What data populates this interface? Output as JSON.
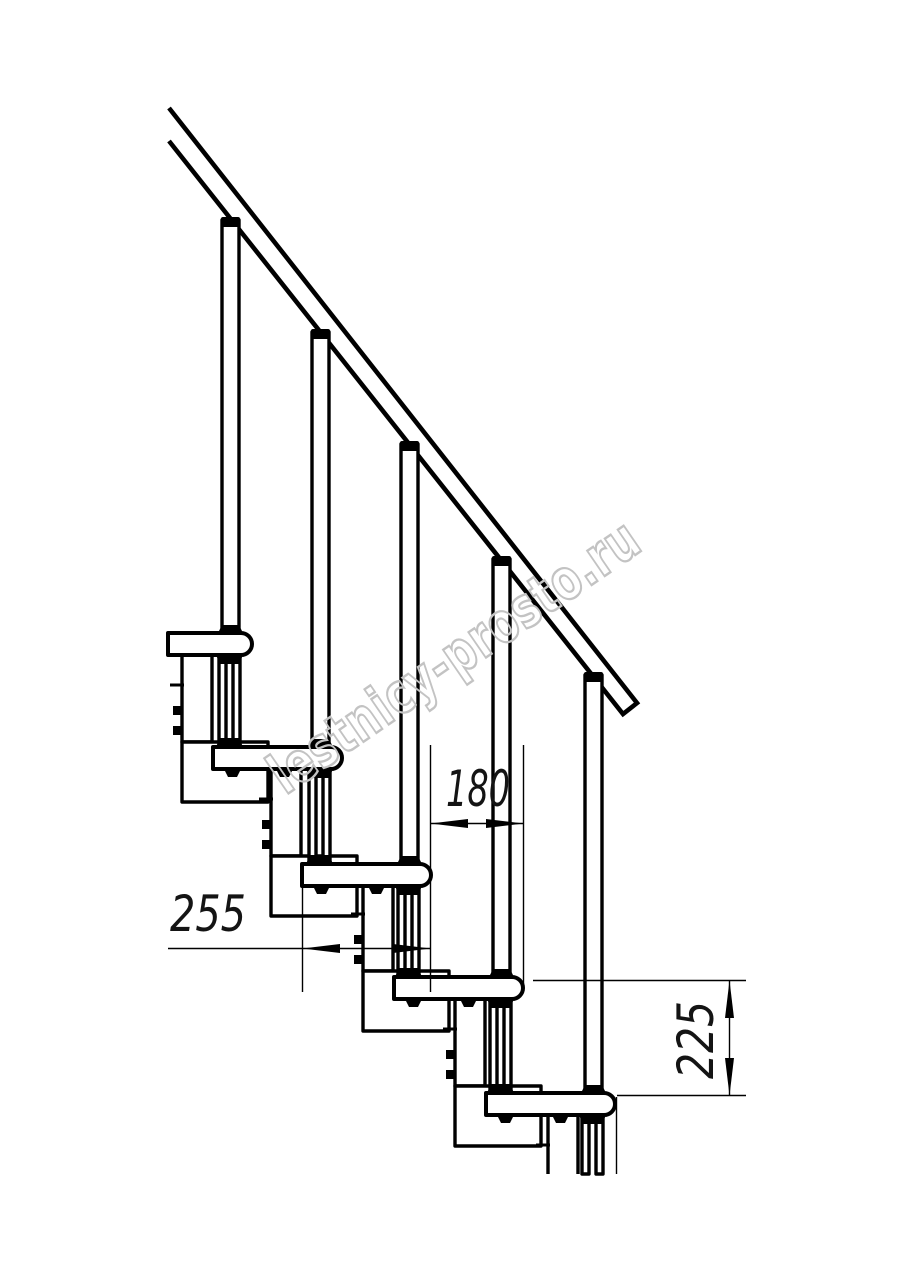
{
  "drawing_type": "staircase-side-elevation",
  "style": {
    "background": "#ffffff",
    "line_color": "#000000"
  },
  "watermark": {
    "text": "lestnicy-prosto.ru",
    "color": "#c3c3c3"
  },
  "dimensions": {
    "tread_depth": {
      "value": "255",
      "orientation": "horizontal"
    },
    "step_run": {
      "value": "180",
      "orientation": "horizontal"
    },
    "step_rise": {
      "value": "225",
      "orientation": "vertical"
    }
  }
}
